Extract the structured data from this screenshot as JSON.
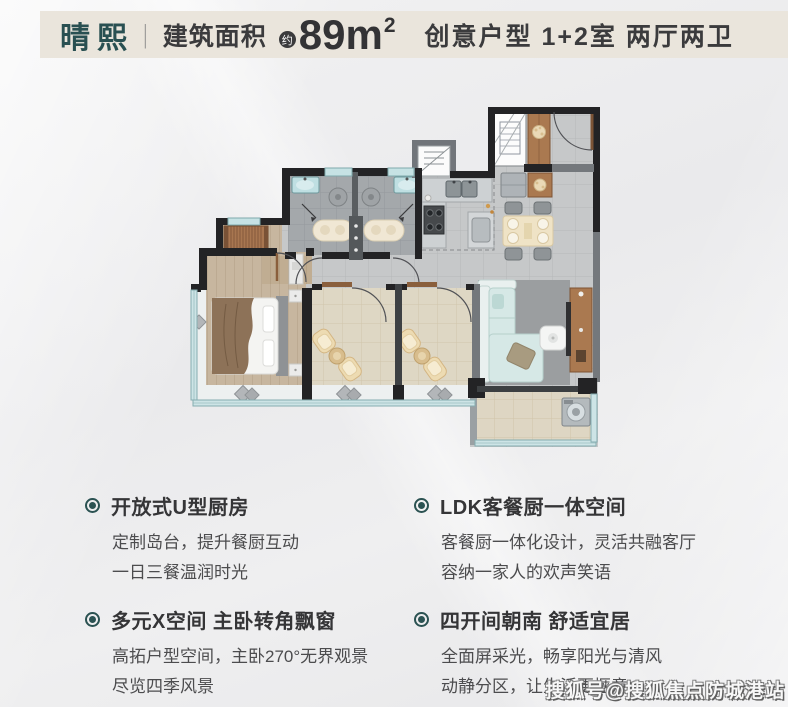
{
  "header": {
    "project_name": "晴熙",
    "separator": "|",
    "area_label": "建筑面积",
    "approx_badge": "约",
    "area_value": "89m",
    "area_sup": "2",
    "type_text": "创意户型 1+2室 两厅两卫"
  },
  "features": [
    {
      "title": "开放式U型厨房",
      "lines": [
        "定制岛台，提升餐厨互动",
        "一日三餐温润时光"
      ]
    },
    {
      "title": "LDK客餐厨一体空间",
      "lines": [
        "客餐厨一体化设计，灵活共融客厅",
        "容纳一家人的欢声笑语"
      ]
    },
    {
      "title": "多元X空间 主卧转角飘窗",
      "lines": [
        "高拓户型空间，主卧270°无界观景",
        "尽览四季风景"
      ]
    },
    {
      "title": "四开间朝南 舒适宜居",
      "lines": [
        "全面屏采光，畅享阳光与清风",
        "动静分区，让生活更惬意"
      ]
    }
  ],
  "watermark": "搜狐号@搜狐焦点防城港站",
  "colors": {
    "accent_teal": "#2b5252",
    "header_band": "#eae5dc",
    "text_dark": "#3b3b3d",
    "text_body": "#4c4c4e",
    "wall": "#232325",
    "window_glass": "#cde4e6",
    "wood": "#aa7950"
  }
}
